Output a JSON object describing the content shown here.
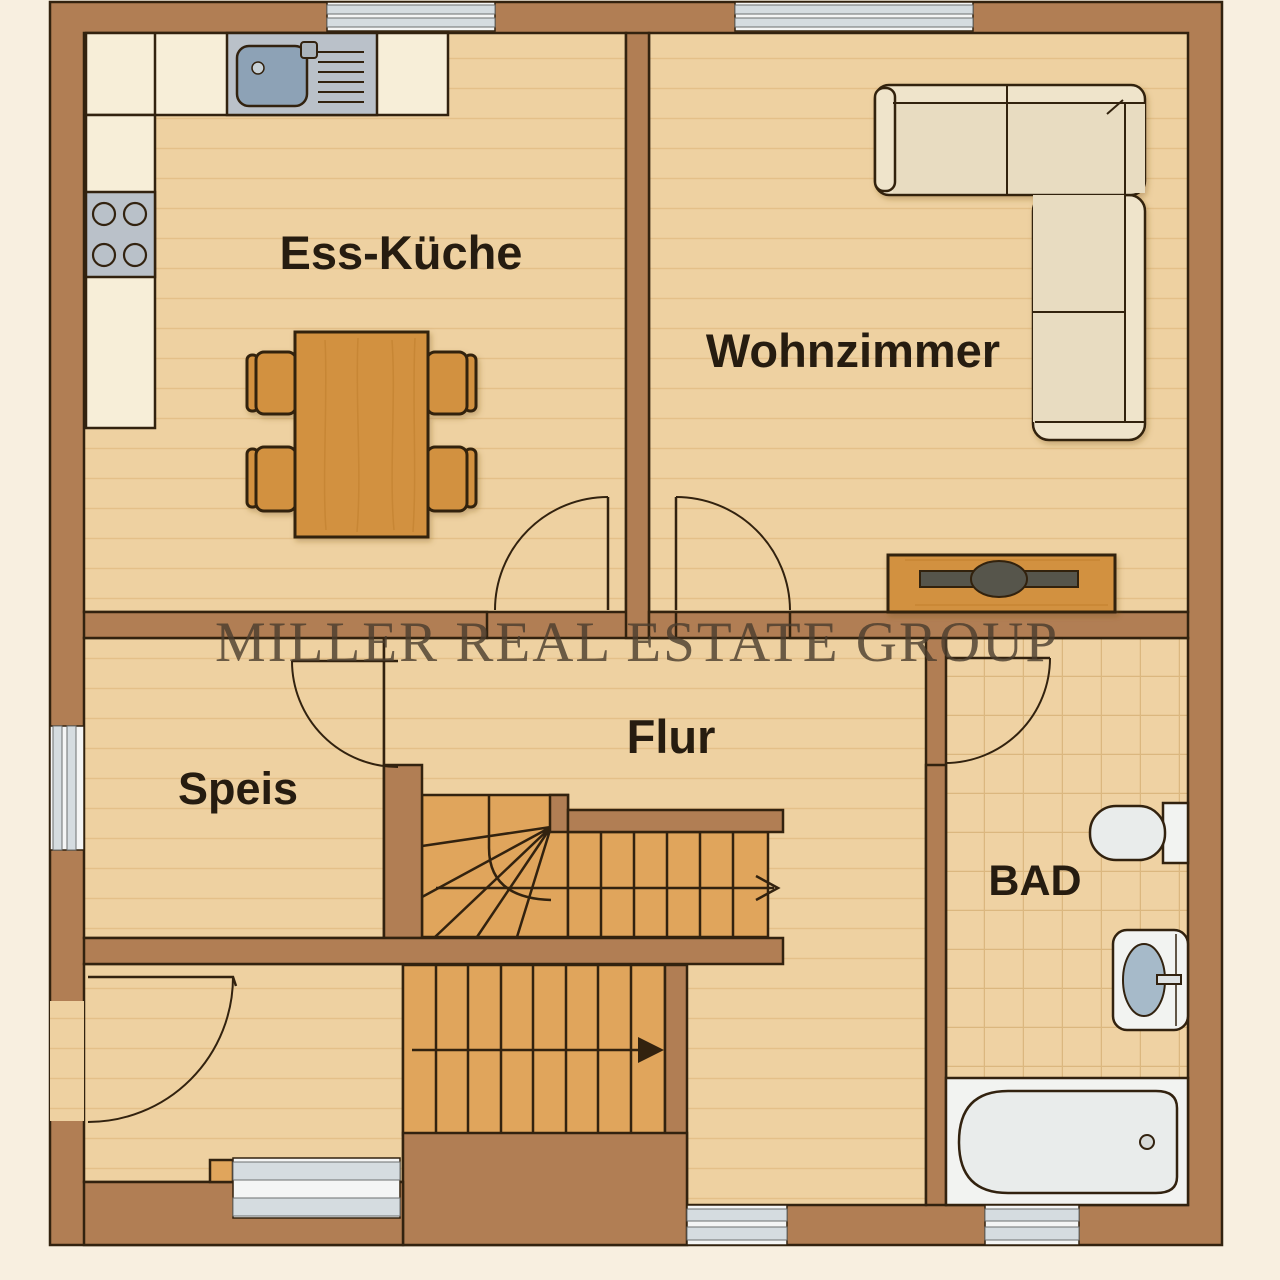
{
  "watermark": {
    "text": "MILLER REAL ESTATE GROUP"
  },
  "rooms": {
    "kitchen": {
      "label": "Ess-Küche"
    },
    "living": {
      "label": "Wohnzimmer"
    },
    "hallway": {
      "label": "Flur"
    },
    "pantry": {
      "label": "Speis"
    },
    "bathroom": {
      "label": "BAD"
    }
  },
  "palette": {
    "bg": "#f8efe0",
    "wall": "#b17e54",
    "line": "#32220f",
    "floor": "#eed1a1",
    "grain": "#d9af72",
    "stair": "#e0a55c",
    "tile": "#efd2a3",
    "tileline": "#dbb77f",
    "counter": "#f7eed8",
    "steel": "#bac1c9",
    "basinblue": "#8da2b6",
    "sofa": "#efe4cb",
    "cushion": "#e8dcc1",
    "wood": "#d2913f",
    "woodgrain": "#bd7e2e",
    "white": "#f2f3f1",
    "fixture": "#e9eceb",
    "blue": "#a6bac9",
    "glass": "#d5dce0",
    "tv": "#56544c",
    "label": "#261c10",
    "watermark": "#4a3d2e"
  }
}
